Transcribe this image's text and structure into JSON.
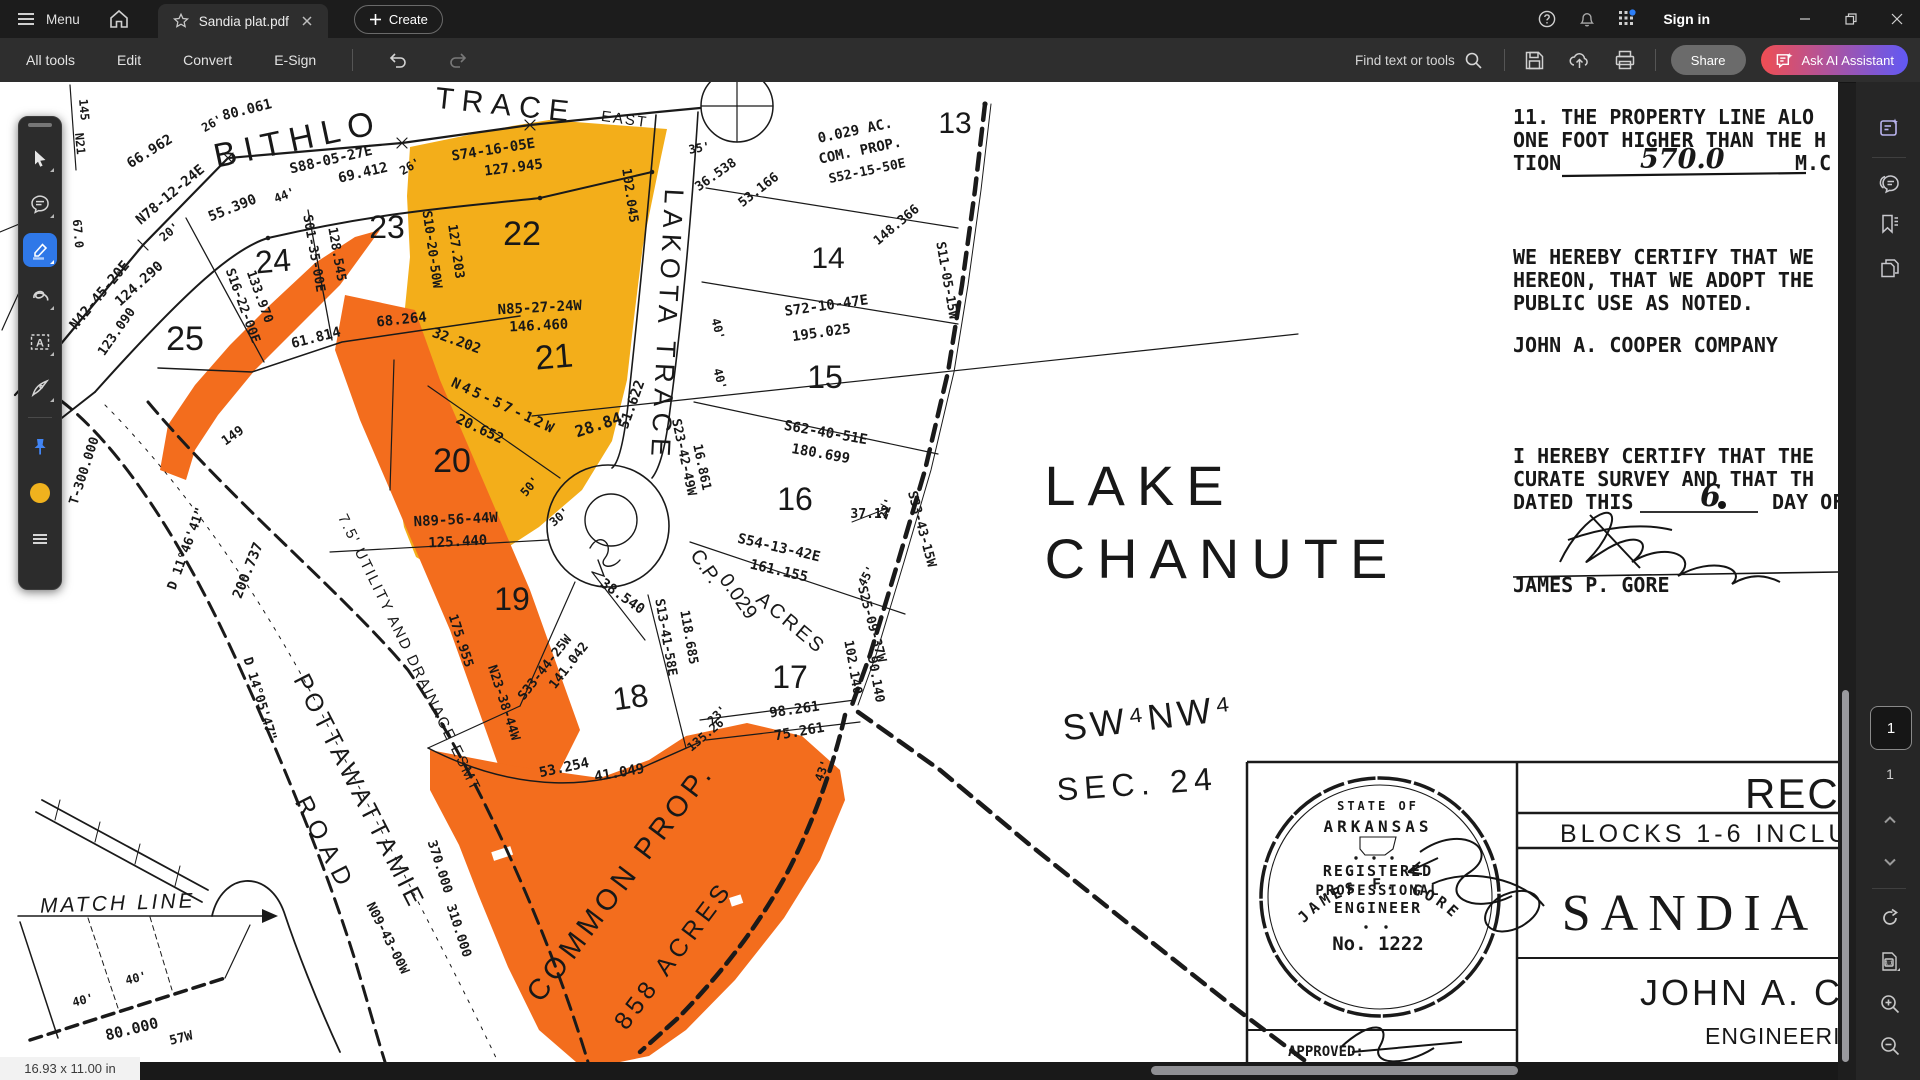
{
  "titlebar": {
    "menu": "Menu",
    "tab_title": "Sandia plat.pdf",
    "create": "Create",
    "sign_in": "Sign in"
  },
  "toolbar": {
    "tabs": [
      "All tools",
      "Edit",
      "Convert",
      "E-Sign"
    ],
    "find": "Find text or tools",
    "share": "Share",
    "ai": "Ask AI Assistant"
  },
  "pager": {
    "current": "1",
    "total": "1"
  },
  "statusbar": {
    "dimensions": "16.93 x 11.00 in"
  },
  "colors": {
    "highlight_yellow": "#F3AE1A",
    "highlight_orange": "#F36D1D",
    "tool_active_blue": "#2F78E8",
    "ai_gradient_left": "#EF4E53",
    "ai_gradient_right": "#6159F5"
  },
  "plat": {
    "seal": {
      "arc_top": "STATE OF",
      "state": "ARKANSAS",
      "line1": "REGISTERED",
      "line2": "PROFESSIONAL",
      "line3": "ENGINEER",
      "number": "No. 1222",
      "name": "JAMES F. GORE"
    },
    "labels": [
      {
        "t": "BITHLO",
        "x": 300,
        "y": 150,
        "r": -12,
        "s": 34,
        "ls": 8,
        "f": "sans"
      },
      {
        "t": "TRACE",
        "x": 505,
        "y": 115,
        "r": 6,
        "s": 30,
        "ls": 8,
        "f": "sans"
      },
      {
        "t": "EAST",
        "x": 624,
        "y": 124,
        "r": 8,
        "s": 15,
        "ls": 2,
        "f": "sans"
      },
      {
        "t": "LAKOTA TRACE",
        "x": 658,
        "y": 325,
        "r": 93,
        "s": 27,
        "ls": 6,
        "f": "sans"
      },
      {
        "t": "LAKE",
        "x": 1140,
        "y": 505,
        "s": 56,
        "ls": 12,
        "f": "sans"
      },
      {
        "t": "CHANUTE",
        "x": 1222,
        "y": 578,
        "s": 56,
        "ls": 12,
        "f": "sans"
      },
      {
        "t": "SW⁴NW⁴",
        "x": 1150,
        "y": 730,
        "r": -7,
        "s": 36,
        "ls": 4,
        "f": "sans"
      },
      {
        "t": "SEC. 24",
        "x": 1138,
        "y": 795,
        "r": -4,
        "s": 32,
        "ls": 6,
        "f": "sans"
      },
      {
        "t": "MATCH LINE",
        "x": 118,
        "y": 910,
        "r": -2,
        "s": 21,
        "ls": 3,
        "f": "sans",
        "fs": "italic"
      },
      {
        "t": "POTTAWATTAMIE",
        "x": 352,
        "y": 795,
        "r": 63,
        "s": 25,
        "ls": 4,
        "f": "sans"
      },
      {
        "t": "ROAD",
        "x": 318,
        "y": 848,
        "r": 63,
        "s": 25,
        "ls": 8,
        "f": "sans"
      },
      {
        "t": "COMMON PROP.",
        "x": 628,
        "y": 888,
        "r": -53,
        "s": 29,
        "ls": 5,
        "f": "sans"
      },
      {
        "t": "858 ACRES",
        "x": 680,
        "y": 960,
        "r": -53,
        "s": 25,
        "ls": 5,
        "f": "sans"
      },
      {
        "t": "C.P.",
        "x": 700,
        "y": 570,
        "r": 55,
        "s": 20,
        "f": "sans"
      },
      {
        "t": "0.029",
        "x": 733,
        "y": 600,
        "r": 55,
        "s": 20,
        "f": "sans"
      },
      {
        "t": "ACRES",
        "x": 787,
        "y": 628,
        "r": 40,
        "s": 20,
        "ls": 3,
        "f": "sans"
      },
      {
        "t": "7.5' UTILITY AND DRAINAGE ESMT",
        "x": 405,
        "y": 655,
        "r": 64,
        "s": 15,
        "ls": 2,
        "f": "sans"
      },
      {
        "t": "13",
        "x": 955,
        "y": 133,
        "s": 30,
        "f": "sans"
      },
      {
        "t": "14",
        "x": 828,
        "y": 268,
        "s": 30,
        "f": "sans"
      },
      {
        "t": "15",
        "x": 825,
        "y": 388,
        "s": 32,
        "f": "sans"
      },
      {
        "t": "16",
        "x": 795,
        "y": 510,
        "s": 32,
        "f": "sans"
      },
      {
        "t": "17",
        "x": 790,
        "y": 688,
        "s": 32,
        "f": "sans"
      },
      {
        "t": "18",
        "x": 632,
        "y": 708,
        "r": -8,
        "s": 32,
        "f": "sans"
      },
      {
        "t": "19",
        "x": 512,
        "y": 610,
        "s": 32,
        "f": "sans"
      },
      {
        "t": "20",
        "x": 452,
        "y": 472,
        "s": 34,
        "f": "sans"
      },
      {
        "t": "21",
        "x": 555,
        "y": 368,
        "r": -5,
        "s": 34,
        "f": "sans"
      },
      {
        "t": "22",
        "x": 522,
        "y": 245,
        "s": 34,
        "f": "sans"
      },
      {
        "t": "23",
        "x": 387,
        "y": 238,
        "s": 32,
        "f": "sans"
      },
      {
        "t": "24",
        "x": 274,
        "y": 272,
        "r": -5,
        "s": 32,
        "f": "sans"
      },
      {
        "t": "25",
        "x": 185,
        "y": 350,
        "s": 34,
        "f": "sans"
      },
      {
        "t": "80.061",
        "x": 248,
        "y": 114,
        "r": -14
      },
      {
        "t": "66.962",
        "x": 152,
        "y": 155,
        "r": -32
      },
      {
        "t": "N78-12-24E",
        "x": 173,
        "y": 198,
        "r": -40
      },
      {
        "t": "S88-05-27E",
        "x": 332,
        "y": 164,
        "r": -13
      },
      {
        "t": "69.412",
        "x": 364,
        "y": 177,
        "r": -13
      },
      {
        "t": "26'",
        "x": 214,
        "y": 127,
        "r": -30,
        "s": 12
      },
      {
        "t": "26'",
        "x": 412,
        "y": 170,
        "r": -30,
        "s": 12
      },
      {
        "t": "55.390",
        "x": 234,
        "y": 212,
        "r": -22
      },
      {
        "t": "44'",
        "x": 286,
        "y": 199,
        "r": -22,
        "s": 12
      },
      {
        "t": "S74-16-05E",
        "x": 494,
        "y": 154,
        "r": -9
      },
      {
        "t": "127.945",
        "x": 514,
        "y": 172,
        "r": -7
      },
      {
        "t": "102.045",
        "x": 626,
        "y": 196,
        "r": 82,
        "s": 13
      },
      {
        "t": "S10-20-50W",
        "x": 428,
        "y": 250,
        "r": 82,
        "s": 13
      },
      {
        "t": "127.203",
        "x": 452,
        "y": 252,
        "r": 82,
        "s": 13
      },
      {
        "t": "S01-35-00E",
        "x": 310,
        "y": 254,
        "r": 80,
        "s": 13
      },
      {
        "t": "128.545",
        "x": 333,
        "y": 255,
        "r": 80,
        "s": 13
      },
      {
        "t": "S16-22-00E",
        "x": 239,
        "y": 307,
        "r": 70,
        "s": 13
      },
      {
        "t": "133.970",
        "x": 256,
        "y": 298,
        "r": 70,
        "s": 13
      },
      {
        "t": "124.290",
        "x": 142,
        "y": 287,
        "r": -42
      },
      {
        "t": "N42-45-20E",
        "x": 103,
        "y": 298,
        "r": -50
      },
      {
        "t": "20'",
        "x": 172,
        "y": 235,
        "r": -40,
        "s": 12
      },
      {
        "t": "N85-27-24W",
        "x": 540,
        "y": 312,
        "r": -3
      },
      {
        "t": "146.460",
        "x": 539,
        "y": 330,
        "r": -3
      },
      {
        "t": "61.814",
        "x": 317,
        "y": 342,
        "r": -14
      },
      {
        "t": "68.264",
        "x": 402,
        "y": 324,
        "r": -6
      },
      {
        "t": "32.202",
        "x": 455,
        "y": 345,
        "r": 20
      },
      {
        "t": "N45-57-12W",
        "x": 502,
        "y": 410,
        "r": 25,
        "ls": 3
      },
      {
        "t": "20.652",
        "x": 478,
        "y": 433,
        "r": 25
      },
      {
        "t": "28.84",
        "x": 600,
        "y": 430,
        "r": -18,
        "s": 16
      },
      {
        "t": "51.622",
        "x": 636,
        "y": 406,
        "r": -70
      },
      {
        "t": "S23-42-49W",
        "x": 680,
        "y": 458,
        "r": 78,
        "s": 13
      },
      {
        "t": "16.861",
        "x": 698,
        "y": 468,
        "r": 78,
        "s": 13
      },
      {
        "t": "40'",
        "x": 714,
        "y": 330,
        "r": 75,
        "s": 12
      },
      {
        "t": "40'",
        "x": 716,
        "y": 380,
        "r": 75,
        "s": 12
      },
      {
        "t": "N89-56-44W",
        "x": 456,
        "y": 524,
        "r": -3
      },
      {
        "t": "125.440",
        "x": 458,
        "y": 546,
        "r": -3
      },
      {
        "t": "30'",
        "x": 562,
        "y": 520,
        "r": -40,
        "s": 12
      },
      {
        "t": "50'",
        "x": 533,
        "y": 489,
        "r": -50,
        "s": 12
      },
      {
        "t": "S72-10-47E",
        "x": 827,
        "y": 310,
        "r": -8
      },
      {
        "t": "195.025",
        "x": 822,
        "y": 337,
        "r": -8
      },
      {
        "t": "S62-40-51E",
        "x": 825,
        "y": 437,
        "r": 10
      },
      {
        "t": "180.699",
        "x": 820,
        "y": 458,
        "r": 10
      },
      {
        "t": "S54-13-42E",
        "x": 778,
        "y": 552,
        "r": 13
      },
      {
        "t": "161.155",
        "x": 778,
        "y": 575,
        "r": 13
      },
      {
        "t": "37.17",
        "x": 870,
        "y": 518,
        "s": 13
      },
      {
        "t": "22'",
        "x": 890,
        "y": 510,
        "r": -70,
        "s": 12
      },
      {
        "t": "45'",
        "x": 870,
        "y": 578,
        "r": -60,
        "s": 12
      },
      {
        "t": "38.540",
        "x": 620,
        "y": 600,
        "r": 35
      },
      {
        "t": "S13-41-58E",
        "x": 662,
        "y": 638,
        "r": 80,
        "s": 13
      },
      {
        "t": "118.685",
        "x": 685,
        "y": 638,
        "r": 80,
        "s": 13
      },
      {
        "t": "S33-44-25W",
        "x": 548,
        "y": 670,
        "r": -52,
        "s": 13
      },
      {
        "t": "141.042",
        "x": 572,
        "y": 668,
        "r": -52,
        "s": 13
      },
      {
        "t": "98.261",
        "x": 795,
        "y": 714,
        "r": -8
      },
      {
        "t": "75.261",
        "x": 800,
        "y": 736,
        "r": -10
      },
      {
        "t": "23'",
        "x": 720,
        "y": 718,
        "r": -45,
        "s": 12
      },
      {
        "t": "43'",
        "x": 826,
        "y": 772,
        "r": -70,
        "s": 12
      },
      {
        "t": "135.26",
        "x": 708,
        "y": 738,
        "r": -40,
        "s": 12
      },
      {
        "t": "53.254",
        "x": 565,
        "y": 772,
        "r": -12
      },
      {
        "t": "41.049",
        "x": 620,
        "y": 777,
        "r": -10
      },
      {
        "t": "175.955",
        "x": 457,
        "y": 642,
        "r": 72,
        "s": 13
      },
      {
        "t": "N23-38-44W",
        "x": 500,
        "y": 704,
        "r": 72,
        "s": 13
      },
      {
        "t": "370.000",
        "x": 436,
        "y": 868,
        "r": 72,
        "s": 13
      },
      {
        "t": "310.000",
        "x": 455,
        "y": 932,
        "r": 72,
        "s": 13
      },
      {
        "t": "102.140",
        "x": 849,
        "y": 668,
        "r": 80,
        "s": 13
      },
      {
        "t": "90.140",
        "x": 872,
        "y": 680,
        "r": 80,
        "s": 13
      },
      {
        "t": "S25-09-37W",
        "x": 868,
        "y": 625,
        "r": 75,
        "s": 13
      },
      {
        "t": "S33-43-15W",
        "x": 918,
        "y": 530,
        "r": 75,
        "s": 13
      },
      {
        "t": "S11-05-15W",
        "x": 943,
        "y": 281,
        "r": 80,
        "s": 13
      },
      {
        "t": "0.029 AC.",
        "x": 856,
        "y": 135,
        "r": -12
      },
      {
        "t": "COM. PROP.",
        "x": 861,
        "y": 155,
        "r": -12
      },
      {
        "t": "S52-15-50E",
        "x": 868,
        "y": 175,
        "r": -12,
        "s": 13
      },
      {
        "t": "148.366",
        "x": 899,
        "y": 228,
        "r": -40,
        "s": 13
      },
      {
        "t": "53.166",
        "x": 761,
        "y": 193,
        "r": -38,
        "s": 13
      },
      {
        "t": "36.538",
        "x": 718,
        "y": 178,
        "r": -35,
        "s": 13
      },
      {
        "t": "35'",
        "x": 700,
        "y": 152,
        "r": -10,
        "s": 12
      },
      {
        "t": "D 14°05'47\"",
        "x": 256,
        "y": 700,
        "r": 73,
        "s": 13
      },
      {
        "t": "N09-43-00W",
        "x": 384,
        "y": 940,
        "r": 63,
        "s": 13
      },
      {
        "t": "80.000",
        "x": 133,
        "y": 1034,
        "r": -14,
        "s": 15
      },
      {
        "t": "40'",
        "x": 84,
        "y": 1004,
        "r": -14,
        "s": 12
      },
      {
        "t": "40'",
        "x": 137,
        "y": 982,
        "r": -14,
        "s": 12
      },
      {
        "t": "57W",
        "x": 182,
        "y": 1042,
        "r": -14,
        "s": 13
      },
      {
        "t": "T-300.000",
        "x": 88,
        "y": 472,
        "r": -72,
        "s": 13
      },
      {
        "t": "200.737",
        "x": 252,
        "y": 572,
        "r": -68
      },
      {
        "t": "D 11°46'41\"",
        "x": 190,
        "y": 550,
        "r": -70,
        "s": 13
      },
      {
        "t": "47°47'55\"",
        "x": 42,
        "y": 480,
        "r": -85,
        "s": 13
      },
      {
        "t": "123.090",
        "x": 120,
        "y": 334,
        "r": -55,
        "s": 13
      },
      {
        "t": "149",
        "x": 235,
        "y": 439,
        "r": -35,
        "s": 13
      },
      {
        "t": "145",
        "x": 80,
        "y": 110,
        "r": 85,
        "s": 12
      },
      {
        "t": "N21",
        "x": 76,
        "y": 144,
        "r": 85,
        "s": 12
      },
      {
        "t": "67.0",
        "x": 74,
        "y": 234,
        "r": 85,
        "s": 12
      },
      {
        "t": "11.  THE PROPERTY LINE ALO",
        "x": 1513,
        "y": 124,
        "s": 20,
        "a": "s"
      },
      {
        "t": "ONE FOOT HIGHER THAN THE H",
        "x": 1513,
        "y": 147,
        "s": 20,
        "a": "s"
      },
      {
        "t": "TION",
        "x": 1513,
        "y": 170,
        "s": 20,
        "a": "s"
      },
      {
        "t": "570.0",
        "x": 1640,
        "y": 168,
        "s": 27,
        "f": "script",
        "a": "s"
      },
      {
        "t": "M.C",
        "x": 1795,
        "y": 170,
        "s": 20,
        "a": "s"
      },
      {
        "t": "WE HEREBY CERTIFY THAT WE",
        "x": 1513,
        "y": 264,
        "s": 20,
        "a": "s"
      },
      {
        "t": "HEREON, THAT WE ADOPT THE",
        "x": 1513,
        "y": 287,
        "s": 20,
        "a": "s"
      },
      {
        "t": "PUBLIC USE AS NOTED.",
        "x": 1513,
        "y": 310,
        "s": 20,
        "a": "s"
      },
      {
        "t": "JOHN A. COOPER COMPANY",
        "x": 1513,
        "y": 352,
        "s": 20,
        "a": "s"
      },
      {
        "t": "I HEREBY CERTIFY THAT THE",
        "x": 1513,
        "y": 463,
        "s": 20,
        "a": "s"
      },
      {
        "t": "CURATE SURVEY AND THAT TH",
        "x": 1513,
        "y": 486,
        "s": 20,
        "a": "s"
      },
      {
        "t": "DATED THIS",
        "x": 1513,
        "y": 509,
        "s": 20,
        "a": "s"
      },
      {
        "t": "6",
        "x": 1700,
        "y": 506,
        "s": 30,
        "f": "script",
        "a": "s"
      },
      {
        "t": "DAY OF",
        "x": 1772,
        "y": 509,
        "s": 20,
        "a": "s"
      },
      {
        "t": "JAMES P. GORE",
        "x": 1513,
        "y": 592,
        "s": 20,
        "a": "s"
      },
      {
        "t": "RECO",
        "x": 1745,
        "y": 808,
        "s": 42,
        "a": "s",
        "f": "sans",
        "w": 700,
        "ls": 2
      },
      {
        "t": "BLOCKS 1-6 INCLUS",
        "x": 1560,
        "y": 842,
        "s": 25,
        "a": "s",
        "f": "sans",
        "ls": 4
      },
      {
        "t": "SANDIA",
        "x": 1690,
        "y": 930,
        "s": 52,
        "f": "serif",
        "ls": 10
      },
      {
        "t": "JOHN A. CO",
        "x": 1640,
        "y": 1005,
        "s": 36,
        "a": "s",
        "f": "sans",
        "w": 700,
        "ls": 3
      },
      {
        "t": "ENGINEERING",
        "x": 1705,
        "y": 1044,
        "s": 23,
        "a": "s",
        "f": "sans",
        "w": 700,
        "ls": 1
      },
      {
        "t": "APPROVED:",
        "x": 1288,
        "y": 1056,
        "s": 14,
        "a": "s"
      },
      {
        "t": "STATE OF",
        "x": 1378,
        "y": 810,
        "s": 12,
        "ls": 3
      },
      {
        "t": "ARKANSAS",
        "x": 1378,
        "y": 832,
        "s": 16,
        "ls": 4
      },
      {
        "t": "REGISTERED",
        "x": 1378,
        "y": 876,
        "s": 15,
        "ls": 2
      },
      {
        "t": "PROFESSIONAL",
        "x": 1378,
        "y": 895,
        "s": 14,
        "ls": 2
      },
      {
        "t": "ENGINEER",
        "x": 1378,
        "y": 913,
        "s": 15,
        "ls": 2
      },
      {
        "t": "No. 1222",
        "x": 1378,
        "y": 950,
        "s": 19
      }
    ]
  }
}
